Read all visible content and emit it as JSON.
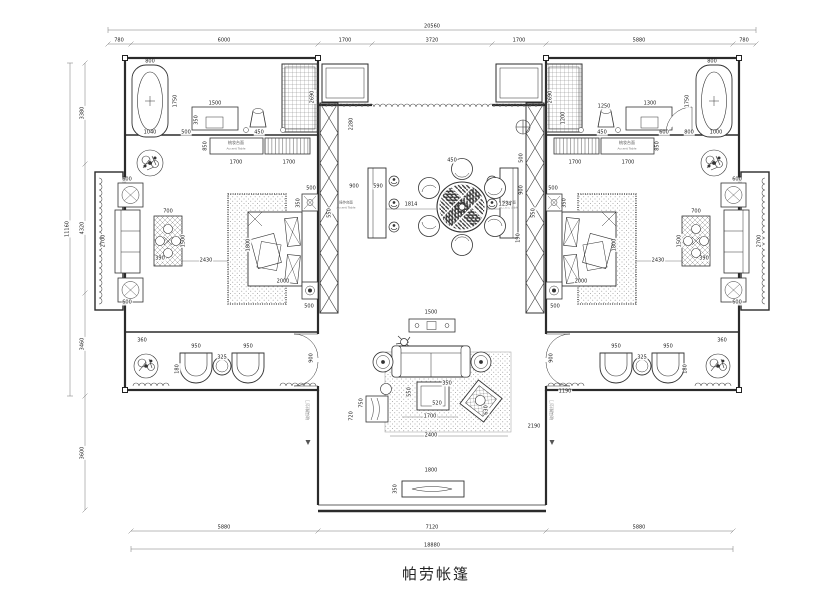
{
  "title": {
    "text": "帕劳帐篷"
  },
  "dimensions": {
    "top_total": "20560",
    "top_segments": [
      "780",
      "6000",
      "1700",
      "3720",
      "1700",
      "5880",
      "780"
    ],
    "left_total": "11160",
    "left_segments": [
      "3380",
      "4320",
      "3460",
      "3600"
    ],
    "bottom_segments": [
      "5880",
      "7120",
      "5880"
    ],
    "bottom_total": "18880"
  },
  "room_labels": {
    "vanity_left": {
      "cn": "梳妆台面",
      "en": "Accent Table"
    },
    "vanity_right": {
      "cn": "梳妆台面",
      "en": "Accent Table"
    },
    "bar_left": {
      "cn": "操作台面",
      "en": "Accent Table"
    },
    "bar_right": {
      "cn": "操作台面",
      "en": "Accent Table"
    },
    "door_left": "玻璃推拉门",
    "door_right": "玻璃推拉门"
  },
  "colors": {
    "line": "#333333",
    "dim_text": "#1c1c1c",
    "paper": "#ffffff"
  },
  "annotations": [
    {
      "t": "800",
      "x": 150,
      "y": 62
    },
    {
      "t": "1750",
      "x": 176,
      "y": 101,
      "v": 1
    },
    {
      "t": "1040",
      "x": 150,
      "y": 133
    },
    {
      "t": "500",
      "x": 186,
      "y": 133
    },
    {
      "t": "350",
      "x": 197,
      "y": 120,
      "v": 1
    },
    {
      "t": "1500",
      "x": 215,
      "y": 104
    },
    {
      "t": "450",
      "x": 259,
      "y": 133
    },
    {
      "t": "2690",
      "x": 313,
      "y": 97,
      "v": 1
    },
    {
      "t": "850",
      "x": 206,
      "y": 146,
      "v": 1
    },
    {
      "t": "1700",
      "x": 236,
      "y": 163
    },
    {
      "t": "1700",
      "x": 289,
      "y": 163
    },
    {
      "t": "800",
      "x": 712,
      "y": 62
    },
    {
      "t": "1750",
      "x": 688,
      "y": 101,
      "v": 1
    },
    {
      "t": "1000",
      "x": 716,
      "y": 133
    },
    {
      "t": "800",
      "x": 689,
      "y": 133
    },
    {
      "t": "600",
      "x": 664,
      "y": 133
    },
    {
      "t": "450",
      "x": 602,
      "y": 133
    },
    {
      "t": "1300",
      "x": 650,
      "y": 104
    },
    {
      "t": "1250",
      "x": 604,
      "y": 107
    },
    {
      "t": "1200",
      "x": 564,
      "y": 118,
      "v": 1
    },
    {
      "t": "2690",
      "x": 551,
      "y": 97,
      "v": 1
    },
    {
      "t": "850",
      "x": 658,
      "y": 146,
      "v": 1
    },
    {
      "t": "1700",
      "x": 628,
      "y": 163
    },
    {
      "t": "1700",
      "x": 575,
      "y": 163
    },
    {
      "t": "1800",
      "x": 249,
      "y": 245,
      "v": 1
    },
    {
      "t": "2000",
      "x": 283,
      "y": 282
    },
    {
      "t": "500",
      "x": 311,
      "y": 189
    },
    {
      "t": "350",
      "x": 299,
      "y": 203,
      "v": 1
    },
    {
      "t": "550",
      "x": 330,
      "y": 213,
      "v": 1
    },
    {
      "t": "500",
      "x": 309,
      "y": 307
    },
    {
      "t": "2430",
      "x": 206,
      "y": 261
    },
    {
      "t": "700",
      "x": 168,
      "y": 212
    },
    {
      "t": "1500",
      "x": 184,
      "y": 241,
      "v": 1
    },
    {
      "t": "390",
      "x": 160,
      "y": 259
    },
    {
      "t": "2700",
      "x": 104,
      "y": 241,
      "v": 1
    },
    {
      "t": "600",
      "x": 127,
      "y": 180
    },
    {
      "t": "600",
      "x": 127,
      "y": 303
    },
    {
      "t": "1800",
      "x": 615,
      "y": 245,
      "v": 1
    },
    {
      "t": "2000",
      "x": 581,
      "y": 282
    },
    {
      "t": "500",
      "x": 553,
      "y": 189
    },
    {
      "t": "350",
      "x": 565,
      "y": 203,
      "v": 1
    },
    {
      "t": "550",
      "x": 534,
      "y": 213,
      "v": 1
    },
    {
      "t": "500",
      "x": 555,
      "y": 307
    },
    {
      "t": "2430",
      "x": 658,
      "y": 261
    },
    {
      "t": "700",
      "x": 696,
      "y": 212
    },
    {
      "t": "1500",
      "x": 680,
      "y": 241,
      "v": 1
    },
    {
      "t": "390",
      "x": 704,
      "y": 259
    },
    {
      "t": "2700",
      "x": 760,
      "y": 241,
      "v": 1
    },
    {
      "t": "600",
      "x": 737,
      "y": 180
    },
    {
      "t": "600",
      "x": 737,
      "y": 303
    },
    {
      "t": "360",
      "x": 142,
      "y": 341
    },
    {
      "t": "950",
      "x": 196,
      "y": 347
    },
    {
      "t": "950",
      "x": 248,
      "y": 347
    },
    {
      "t": "325",
      "x": 222,
      "y": 358
    },
    {
      "t": "180",
      "x": 178,
      "y": 369,
      "v": 1
    },
    {
      "t": "900",
      "x": 312,
      "y": 358,
      "v": 1
    },
    {
      "t": "360",
      "x": 722,
      "y": 341
    },
    {
      "t": "950",
      "x": 668,
      "y": 347
    },
    {
      "t": "950",
      "x": 616,
      "y": 347
    },
    {
      "t": "325",
      "x": 642,
      "y": 358
    },
    {
      "t": "180",
      "x": 686,
      "y": 369,
      "v": 1
    },
    {
      "t": "900",
      "x": 552,
      "y": 358,
      "v": 1
    },
    {
      "t": "2280",
      "x": 352,
      "y": 124,
      "v": 1
    },
    {
      "t": "900",
      "x": 354,
      "y": 187
    },
    {
      "t": "590",
      "x": 378,
      "y": 187
    },
    {
      "t": "1814",
      "x": 411,
      "y": 205
    },
    {
      "t": "450",
      "x": 452,
      "y": 161
    },
    {
      "t": "1234",
      "x": 505,
      "y": 205
    },
    {
      "t": "500",
      "x": 522,
      "y": 158,
      "v": 1
    },
    {
      "t": "900",
      "x": 522,
      "y": 190,
      "v": 1
    },
    {
      "t": "190",
      "x": 519,
      "y": 238,
      "v": 1
    },
    {
      "t": "1500",
      "x": 431,
      "y": 313
    },
    {
      "t": "750",
      "x": 362,
      "y": 403,
      "v": 1
    },
    {
      "t": "720",
      "x": 352,
      "y": 416,
      "v": 1
    },
    {
      "t": "550",
      "x": 410,
      "y": 392,
      "v": 1
    },
    {
      "t": "350",
      "x": 447,
      "y": 384
    },
    {
      "t": "520",
      "x": 437,
      "y": 404
    },
    {
      "t": "1700",
      "x": 430,
      "y": 417
    },
    {
      "t": "2400",
      "x": 431,
      "y": 436
    },
    {
      "t": "1190",
      "x": 565,
      "y": 392
    },
    {
      "t": "2190",
      "x": 534,
      "y": 427
    },
    {
      "t": "630",
      "x": 487,
      "y": 410,
      "v": 1
    },
    {
      "t": "1800",
      "x": 431,
      "y": 471
    },
    {
      "t": "350",
      "x": 396,
      "y": 489,
      "v": 1
    }
  ]
}
